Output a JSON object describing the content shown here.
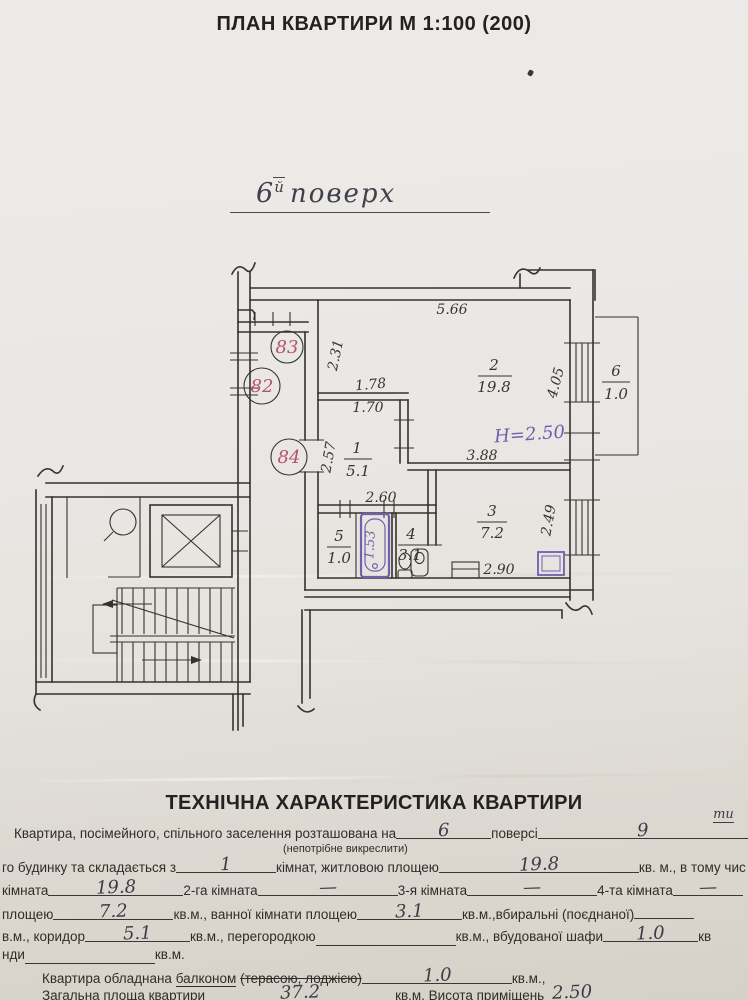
{
  "page": {
    "title": "ПЛАН КВАРТИРИ М 1:100 (200)",
    "floor_note": {
      "num": "6",
      "sup": "й",
      "word": "поверх"
    }
  },
  "plan": {
    "dims": {
      "top": "5.66",
      "left": "2.31",
      "hall_w1": "1.78",
      "hall_w2": "1.70",
      "right": "4.05",
      "room2_bottom": "3.88",
      "hall_left": "2.57",
      "bath_top": "2.60",
      "kitchen_bottom": "2.90",
      "kitchen_right": "2.49"
    },
    "rooms": {
      "r1": {
        "num": "1",
        "area": "5.1"
      },
      "r2": {
        "num": "2",
        "area": "19.8"
      },
      "r3": {
        "num": "3",
        "area": "7.2"
      },
      "r4": {
        "num": "4",
        "area": "3.1"
      },
      "r5": {
        "num": "5",
        "area": "1.0"
      },
      "r6": {
        "num": "6",
        "area": "1.0"
      }
    },
    "notes": {
      "height": "Н=2.50",
      "tub": "1.53"
    },
    "unit_numbers": {
      "n83": "83",
      "n82": "82",
      "n84": "84"
    },
    "colors": {
      "ink": "#35322e",
      "pink": "#b84f76",
      "purple": "#6f5fae"
    }
  },
  "tech": {
    "heading": "ТЕХНІЧНА ХАРАКТЕРИСТИКА КВАРТИРИ",
    "l1a": "Квартира, посімейного, спільного заселення розташована на",
    "l1v1": "6",
    "l1b": "поверсі",
    "l1v2": "9",
    "l1v2sup": "ти",
    "l1c": "пов",
    "l1note": "(непотрібне викреслити)",
    "l2a": "го будинку та складається з",
    "l2v1": "1",
    "l2b": "кімнат, житловою площею",
    "l2v2": "19.8",
    "l2c": "кв. м., в тому чис",
    "l3a": "кімната",
    "l3v1": "19.8",
    "l3b": "2-га кімната",
    "l3v2": "—",
    "l3c": "3-я кімната",
    "l3v3": "—",
    "l3d": "4-та кімната",
    "l3v4": "—",
    "l4a": "площею",
    "l4v1": "7.2",
    "l4b": "кв.м., ванної кімнати площею",
    "l4v2": "3.1",
    "l4c": "кв.м.,вбиральні (поєднаної)",
    "l5a": "в.м., коридор",
    "l5v1": "5.1",
    "l5b": "кв.м., перегородкою",
    "l5v2": "",
    "l5c": "кв.м., вбудованої шафи",
    "l5v3": "1.0",
    "l5d": "кв",
    "l6a": "нди",
    "l6v": "",
    "l6b": "кв.м.",
    "l7a": "Квартира обладнана",
    "l7b": "балконом",
    "l7c": "(терасою, лоджією)",
    "l7v": "1.0",
    "l7d": "кв.м.,",
    "l8a": "Загальна площа квартири",
    "l8v1": "37.2",
    "l8b": "кв.м. Висота приміщень",
    "l8v2": "2.50"
  }
}
